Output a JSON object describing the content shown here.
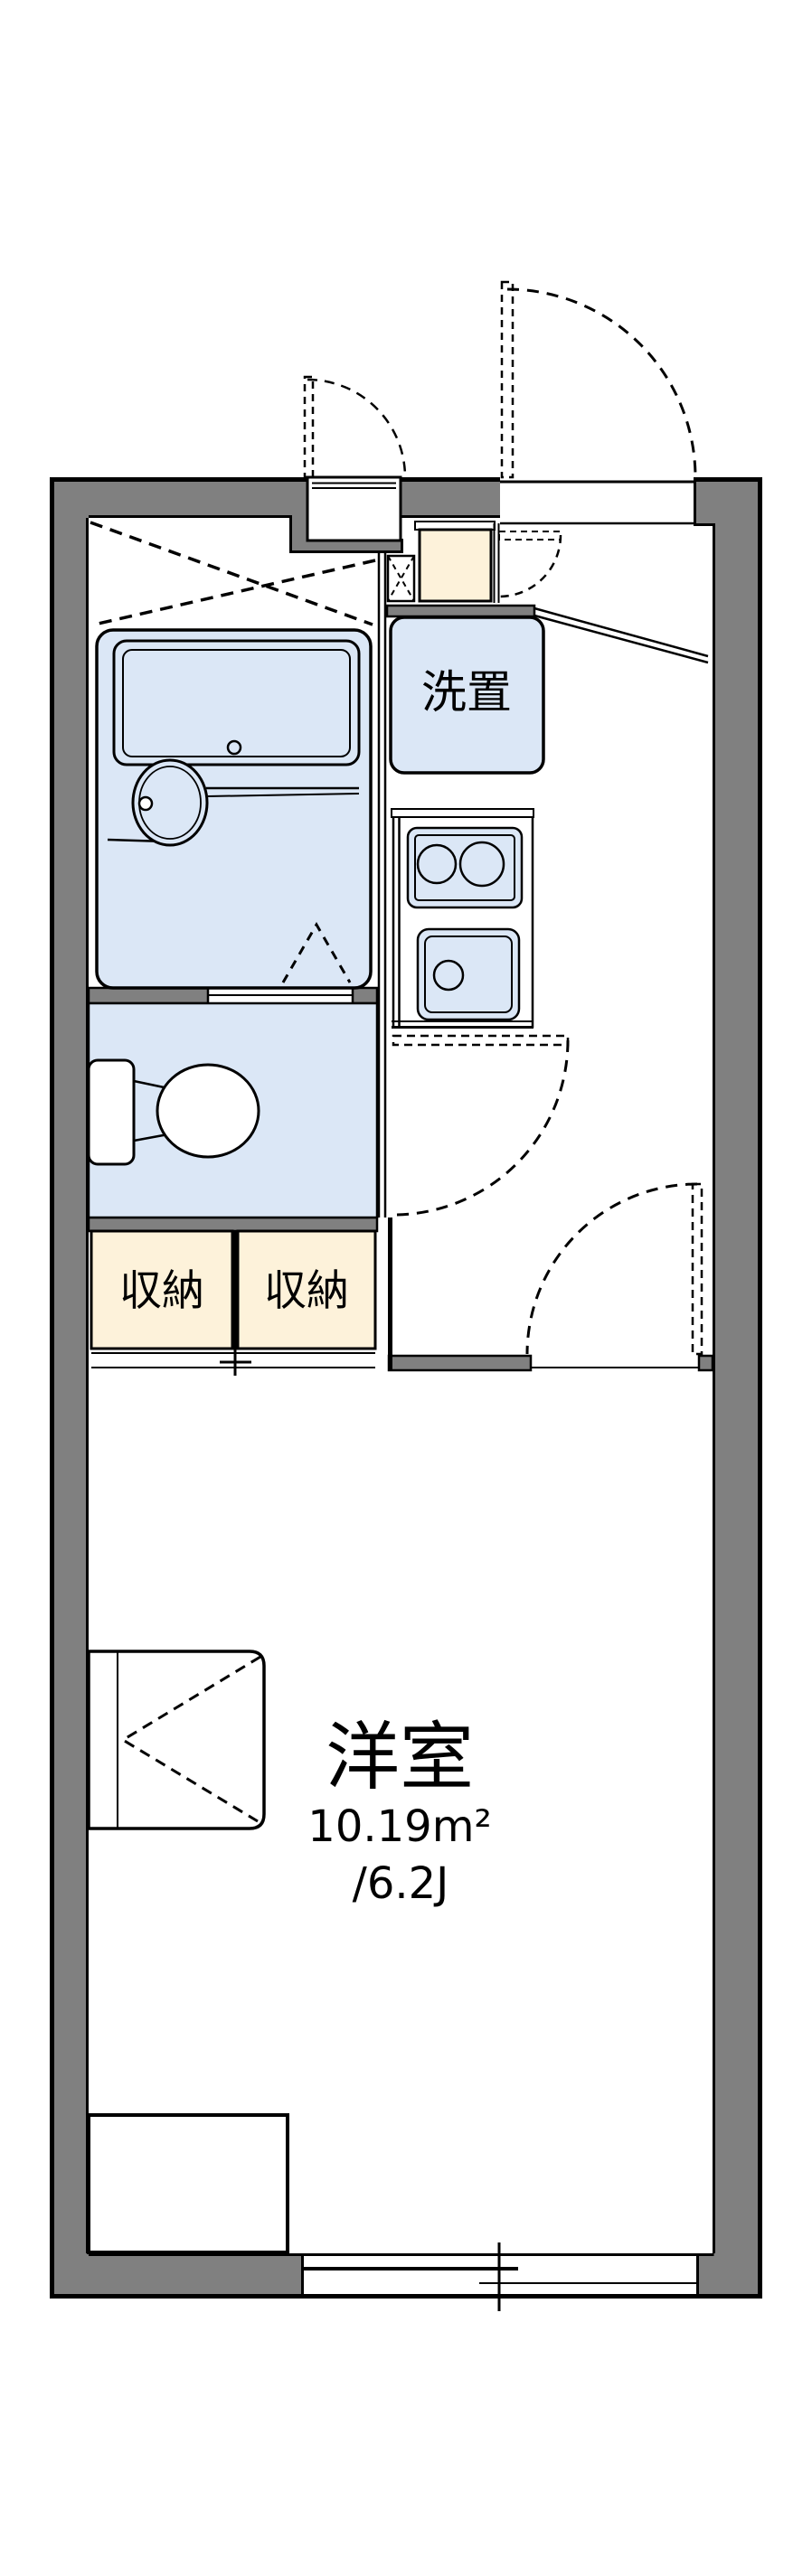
{
  "floorplan": {
    "rooms": {
      "western_room": {
        "label": "洋室",
        "area_sqm": "10.19m²",
        "area_tatami": "/6.2J"
      },
      "laundry_space": {
        "label": "洗置"
      },
      "storage_left": {
        "label": "収納"
      },
      "storage_right": {
        "label": "収納"
      }
    },
    "colors": {
      "wall_gray": "#808080",
      "wet_area_blue": "#dbe7f6",
      "storage_cream": "#fdf2da",
      "line_black": "#000000",
      "background_white": "#ffffff"
    }
  }
}
